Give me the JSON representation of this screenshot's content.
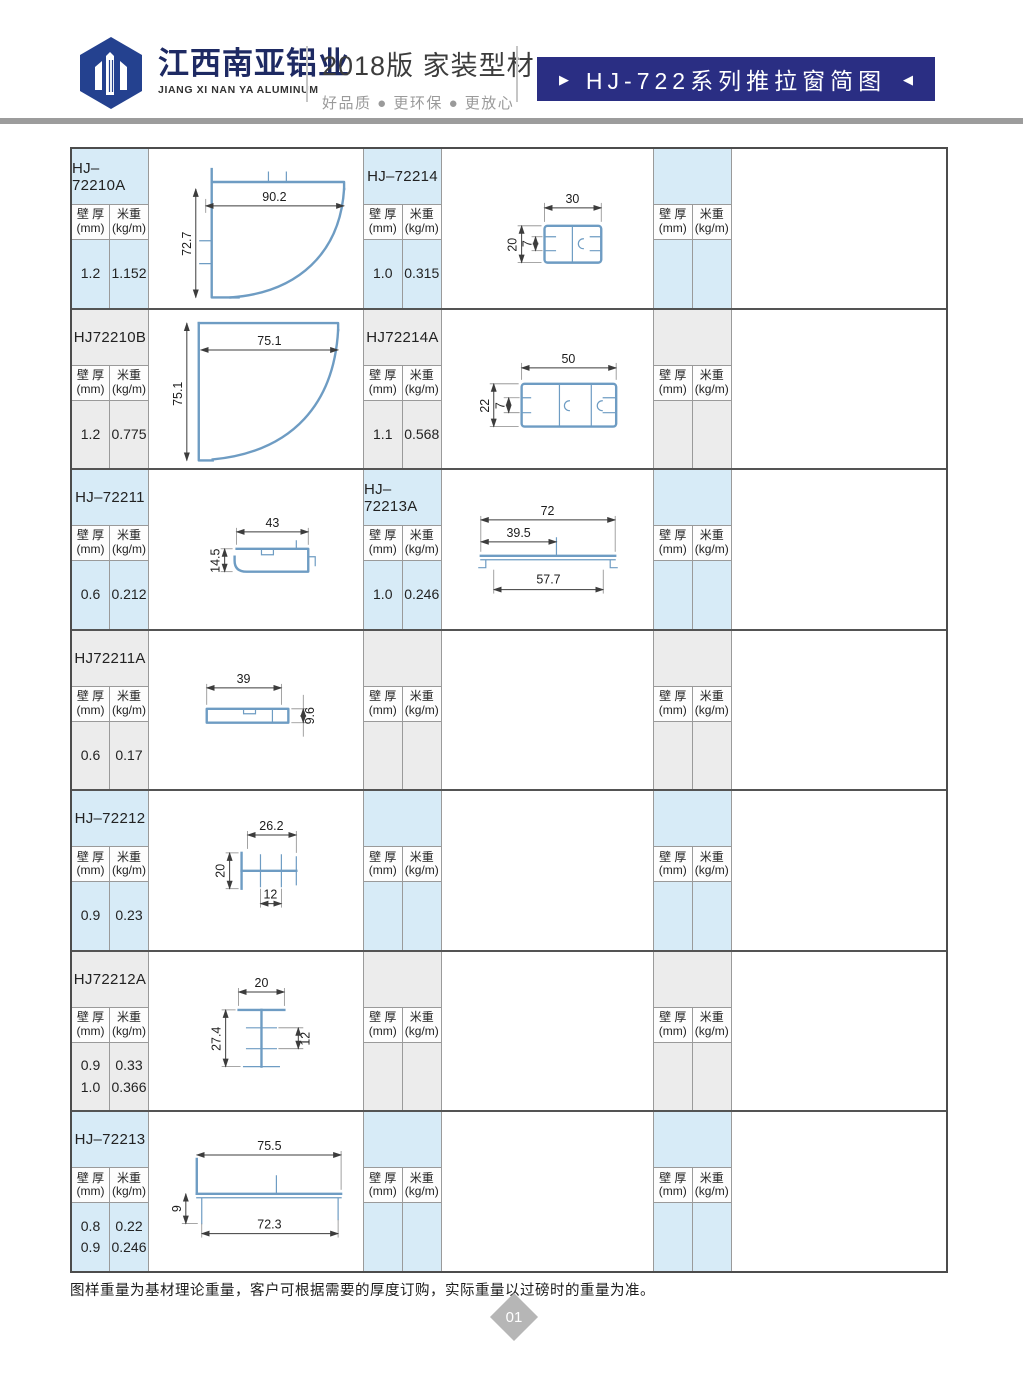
{
  "header": {
    "company_cn": "江西南亚铝业",
    "company_en": "JIANG XI NAN YA ALUMINUM",
    "edition": "2018版  家装型材",
    "tagline": "好品质 ● 更环保 ● 更放心",
    "banner_title": "HJ-722系列推拉窗简图",
    "banner_left": "▶",
    "banner_right": "◀"
  },
  "colors": {
    "banner_navy": "#2a2e83",
    "logo_navy": "#24418f",
    "row_blue": "#d7ebf7",
    "row_gray": "#ececec",
    "profile_line": "#6e9cc3",
    "divider_gray": "#9c9c9c"
  },
  "table": {
    "spec_header": {
      "wall_label": "壁 厚",
      "wall_unit": "(mm)",
      "weight_label": "米重",
      "weight_unit": "(kg/m)"
    },
    "rows": [
      {
        "left": {
          "model": "HJ–72210A",
          "wall": "1.2",
          "weight": "1.152",
          "dims": [
            "90.2",
            "72.7"
          ]
        },
        "middle": {
          "model": "HJ–72214",
          "wall": "1.0",
          "weight": "0.315",
          "dims": [
            "30",
            "20",
            "7"
          ]
        },
        "right": {
          "model": "",
          "wall": "",
          "weight": ""
        }
      },
      {
        "left": {
          "model": "HJ72210B",
          "wall": "1.2",
          "weight": "0.775",
          "dims": [
            "75.1",
            "75.1"
          ]
        },
        "middle": {
          "model": "HJ72214A",
          "wall": "1.1",
          "weight": "0.568",
          "dims": [
            "50",
            "22",
            "7"
          ]
        },
        "right": {
          "model": "",
          "wall": "",
          "weight": ""
        }
      },
      {
        "left": {
          "model": "HJ–72211",
          "wall": "0.6",
          "weight": "0.212",
          "dims": [
            "43",
            "14.5"
          ]
        },
        "middle": {
          "model": "HJ–72213A",
          "wall": "1.0",
          "weight": "0.246",
          "dims": [
            "72",
            "39.5",
            "57.7"
          ]
        },
        "right": {
          "model": "",
          "wall": "",
          "weight": ""
        }
      },
      {
        "left": {
          "model": "HJ72211A",
          "wall": "0.6",
          "weight": "0.17",
          "dims": [
            "39",
            "9.6"
          ]
        },
        "middle": {
          "model": "",
          "wall": "",
          "weight": "",
          "dims": []
        },
        "right": {
          "model": "",
          "wall": "",
          "weight": ""
        }
      },
      {
        "left": {
          "model": "HJ–72212",
          "wall": "0.9",
          "weight": "0.23",
          "dims": [
            "26.2",
            "20",
            "12"
          ]
        },
        "middle": {
          "model": "",
          "wall": "",
          "weight": "",
          "dims": []
        },
        "right": {
          "model": "",
          "wall": "",
          "weight": ""
        }
      },
      {
        "left": {
          "model": "HJ72212A",
          "wall": "0.9\n1.0",
          "weight": "0.33\n0.366",
          "dims": [
            "20",
            "27.4",
            "12"
          ]
        },
        "middle": {
          "model": "",
          "wall": "",
          "weight": "",
          "dims": []
        },
        "right": {
          "model": "",
          "wall": "",
          "weight": ""
        }
      },
      {
        "left": {
          "model": "HJ–72213",
          "wall": "0.8\n0.9",
          "weight": "0.22\n0.246",
          "dims": [
            "75.5",
            "9",
            "72.3"
          ]
        },
        "middle": {
          "model": "",
          "wall": "",
          "weight": "",
          "dims": []
        },
        "right": {
          "model": "",
          "wall": "",
          "weight": ""
        }
      }
    ]
  },
  "footer": {
    "note": "图样重量为基材理论重量，客户可根据需要的厚度订购，实际重量以过磅时的重量为准。",
    "page_number": "01"
  }
}
